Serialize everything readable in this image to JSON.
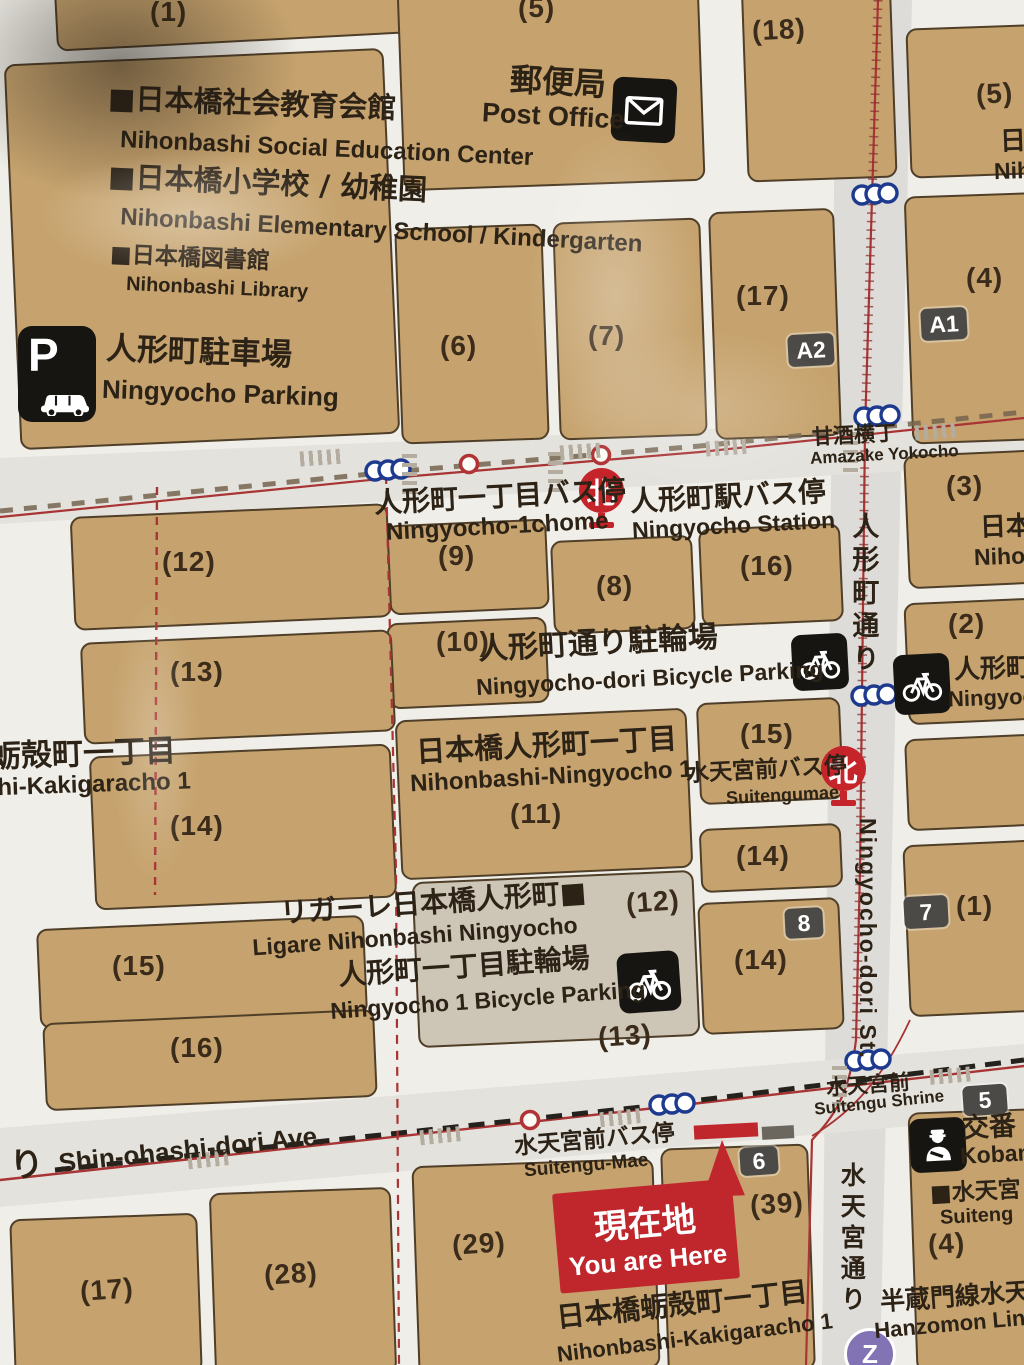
{
  "map_title": "Ningyocho / Nihonbashi area guide map",
  "colors": {
    "block_tan": "#c6a36e",
    "street": "#f0eee8",
    "main_street": "#dedcd8",
    "red_route": "#a83434",
    "badge_dark": "#4c4a47",
    "red_marker": "#c0272d",
    "blue_exit": "#1d3a8f",
    "purple_line": "#8273b4",
    "black_icon": "#171512"
  },
  "icons": {
    "post_office": "envelope-icon",
    "parking": "p-car-icon",
    "bus_stop": "kita-bus-icon",
    "bicycle_parking": "bicycle-icon",
    "koban": "police-officer-icon",
    "station_exit": "linked-circles-icon",
    "hanzomon": "z-line-icon",
    "you_are_here": "red-triangle-marker"
  },
  "facilities": {
    "social_jp": "■日本橋社会教育会館",
    "social_en": "Nihonbashi Social Education Center",
    "school_jp": "■日本橋小学校 / 幼稚園",
    "school_en": "Nihonbashi Elementary School / Kindergarten",
    "library_jp": "■日本橋図書館",
    "library_en": "Nihonbashi Library",
    "parking_jp": "人形町駐車場",
    "parking_en": "Ningyocho Parking",
    "parking_p": "P",
    "post_jp": "郵便局",
    "post_en": "Post Office",
    "bike1_jp": "人形町通り駐輪場",
    "bike1_en": "Ningyocho-dori Bicycle Parking",
    "bike2_jp": "人形町一丁目駐輪場",
    "bike2_en": "Ningyocho 1 Bicycle Parking",
    "bike3_jp": "人形町",
    "bike3_en": "Ningyoc",
    "ligare_jp": "リガーレ日本橋人形町■",
    "ligare_en": "Ligare Nihonbashi Ningyocho",
    "koban_jp": "交番",
    "koban_en": "Koban",
    "suitengu_cut_jp": "■水天宮",
    "suitengu_cut_en": "Suiteng",
    "hanzomon_jp": "半蔵門線水天",
    "hanzomon_en": "Hanzomon Line",
    "nihon_cut_jp": "日本",
    "nihon_cut_en": "Nihon",
    "r5_cut_jp": "日本",
    "r5_cut_en": "Nihon"
  },
  "districts": {
    "kakigaracho_jp": "蛎殻町一丁目",
    "kakigaracho_en": "shi-Kakigaracho 1",
    "ningyocho1_jp": "日本橋人形町一丁目",
    "ningyocho1_en": "Nihonbashi-Ningyocho 1",
    "kakigaracho2_jp": "日本橋蛎殻町一丁目",
    "kakigaracho2_en": "Nihonbashi-Kakigaracho 1"
  },
  "stops": {
    "n1chome_jp": "人形町一丁目バス停",
    "n1chome_en": "Ningyocho-1chome",
    "nstation_jp": "人形町駅バス停",
    "nstation_en": "Ningyocho Station",
    "suitengumae_jp": "水天宮前バス停",
    "suitengumae_en": "Suitengumae",
    "suitengumae2_jp": "水天宮前バス停",
    "suitengumae2_en": "Suitengu-Mae",
    "shrine_jp": "水天宮前",
    "shrine_en": "Suitengu Shrine",
    "kita": "北"
  },
  "streets": {
    "amazake_jp": "甘酒横丁",
    "amazake_en": "Amazake Yokocho",
    "ningyochodori_jp": "人形町通り",
    "ningyochodori_en": "Ningyocho-dori St.",
    "suitengudori_jp": "水天宮通り",
    "shinohashi_en": "Shin-ohashi-dori Ave.",
    "shinohashi_jp_cut": "り"
  },
  "marker": {
    "genzaichi_jp": "現在地",
    "genzaichi_en": "You are Here"
  },
  "badges": {
    "a1": "A1",
    "a2": "A2",
    "e5": "5",
    "e6": "6",
    "e7": "7",
    "e8": "8",
    "z": "Z"
  },
  "numbers": {
    "n1": "(1)",
    "n5a": "(5)",
    "n18": "(18)",
    "n5r": "(5)",
    "n6": "(6)",
    "n7": "(7)",
    "n17a": "(17)",
    "n4r": "(4)",
    "n3": "(3)",
    "n12": "(12)",
    "n9": "(9)",
    "n8": "(8)",
    "n16a": "(16)",
    "n13": "(13)",
    "n10": "(10)",
    "n2": "(2)",
    "n14l": "(14)",
    "n11": "(11)",
    "n15a": "(15)",
    "n14b": "(14)",
    "n14c": "(14)",
    "n12b": "(12)",
    "n13b": "(13)",
    "n1r": "(1)",
    "n15l": "(15)",
    "n16l": "(16)",
    "n39": "(39)",
    "n29": "(29)",
    "n28": "(28)",
    "n17b": "(17)",
    "n4b": "(4)"
  }
}
